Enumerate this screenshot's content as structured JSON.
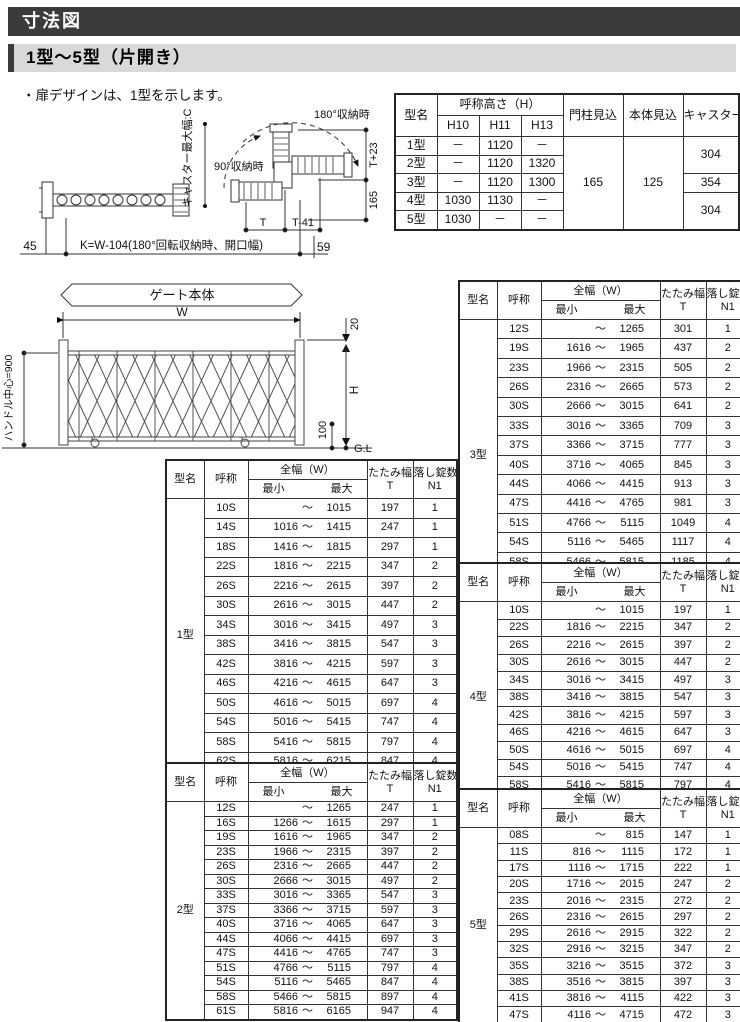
{
  "page": {
    "title": "寸法図",
    "subtitle": "1型～5型（片開き）",
    "note": "・扉デザインは、1型を示します。"
  },
  "spec_table": {
    "headers": {
      "model": "型名",
      "height_group": "呼称高さ（H）",
      "h10": "H10",
      "h11": "H11",
      "h13": "H13",
      "post_depth": "門柱見込",
      "body_depth": "本体見込",
      "caster": "キャスター最大幅（C）"
    },
    "rows": [
      {
        "model": "1型",
        "h10": "－",
        "h11": "1120",
        "h13": "－"
      },
      {
        "model": "2型",
        "h10": "－",
        "h11": "1120",
        "h13": "1320"
      },
      {
        "model": "3型",
        "h10": "－",
        "h11": "1120",
        "h13": "1300"
      },
      {
        "model": "4型",
        "h10": "1030",
        "h11": "1130",
        "h13": "－"
      },
      {
        "model": "5型",
        "h10": "1030",
        "h11": "－",
        "h13": "－"
      }
    ],
    "post_depth_value": "165",
    "body_depth_value": "125",
    "caster_spans": [
      {
        "value": "304",
        "rows": 2
      },
      {
        "value": "354",
        "rows": 1
      },
      {
        "value": "304",
        "rows": 2
      }
    ]
  },
  "size_headers": {
    "model": "型名",
    "name": "呼称",
    "width": "全幅（W）",
    "min": "最小",
    "max": "最大",
    "tilde": "～",
    "fold_line1": "たたみ幅",
    "fold_line2": "T",
    "locks_line1": "落し錠数",
    "locks_line2": "N1"
  },
  "size_tables": [
    {
      "model": "1型",
      "rows": [
        {
          "name": "10S",
          "min": "",
          "max": "1015",
          "t": "197",
          "n1": "1"
        },
        {
          "name": "14S",
          "min": "1016",
          "max": "1415",
          "t": "247",
          "n1": "1"
        },
        {
          "name": "18S",
          "min": "1416",
          "max": "1815",
          "t": "297",
          "n1": "1"
        },
        {
          "name": "22S",
          "min": "1816",
          "max": "2215",
          "t": "347",
          "n1": "2"
        },
        {
          "name": "26S",
          "min": "2216",
          "max": "2615",
          "t": "397",
          "n1": "2"
        },
        {
          "name": "30S",
          "min": "2616",
          "max": "3015",
          "t": "447",
          "n1": "2"
        },
        {
          "name": "34S",
          "min": "3016",
          "max": "3415",
          "t": "497",
          "n1": "3"
        },
        {
          "name": "38S",
          "min": "3416",
          "max": "3815",
          "t": "547",
          "n1": "3"
        },
        {
          "name": "42S",
          "min": "3816",
          "max": "4215",
          "t": "597",
          "n1": "3"
        },
        {
          "name": "46S",
          "min": "4216",
          "max": "4615",
          "t": "647",
          "n1": "3"
        },
        {
          "name": "50S",
          "min": "4616",
          "max": "5015",
          "t": "697",
          "n1": "4"
        },
        {
          "name": "54S",
          "min": "5016",
          "max": "5415",
          "t": "747",
          "n1": "4"
        },
        {
          "name": "58S",
          "min": "5416",
          "max": "5815",
          "t": "797",
          "n1": "4"
        },
        {
          "name": "62S",
          "min": "5816",
          "max": "6215",
          "t": "847",
          "n1": "4"
        }
      ]
    },
    {
      "model": "2型",
      "rows": [
        {
          "name": "12S",
          "min": "",
          "max": "1265",
          "t": "247",
          "n1": "1"
        },
        {
          "name": "16S",
          "min": "1266",
          "max": "1615",
          "t": "297",
          "n1": "1"
        },
        {
          "name": "19S",
          "min": "1616",
          "max": "1965",
          "t": "347",
          "n1": "2"
        },
        {
          "name": "23S",
          "min": "1966",
          "max": "2315",
          "t": "397",
          "n1": "2"
        },
        {
          "name": "26S",
          "min": "2316",
          "max": "2665",
          "t": "447",
          "n1": "2"
        },
        {
          "name": "30S",
          "min": "2666",
          "max": "3015",
          "t": "497",
          "n1": "2"
        },
        {
          "name": "33S",
          "min": "3016",
          "max": "3365",
          "t": "547",
          "n1": "3"
        },
        {
          "name": "37S",
          "min": "3366",
          "max": "3715",
          "t": "597",
          "n1": "3"
        },
        {
          "name": "40S",
          "min": "3716",
          "max": "4065",
          "t": "647",
          "n1": "3"
        },
        {
          "name": "44S",
          "min": "4066",
          "max": "4415",
          "t": "697",
          "n1": "3"
        },
        {
          "name": "47S",
          "min": "4416",
          "max": "4765",
          "t": "747",
          "n1": "3"
        },
        {
          "name": "51S",
          "min": "4766",
          "max": "5115",
          "t": "797",
          "n1": "4"
        },
        {
          "name": "54S",
          "min": "5116",
          "max": "5465",
          "t": "847",
          "n1": "4"
        },
        {
          "name": "58S",
          "min": "5466",
          "max": "5815",
          "t": "897",
          "n1": "4"
        },
        {
          "name": "61S",
          "min": "5816",
          "max": "6165",
          "t": "947",
          "n1": "4"
        }
      ]
    },
    {
      "model": "3型",
      "rows": [
        {
          "name": "12S",
          "min": "",
          "max": "1265",
          "t": "301",
          "n1": "1"
        },
        {
          "name": "19S",
          "min": "1616",
          "max": "1965",
          "t": "437",
          "n1": "2"
        },
        {
          "name": "23S",
          "min": "1966",
          "max": "2315",
          "t": "505",
          "n1": "2"
        },
        {
          "name": "26S",
          "min": "2316",
          "max": "2665",
          "t": "573",
          "n1": "2"
        },
        {
          "name": "30S",
          "min": "2666",
          "max": "3015",
          "t": "641",
          "n1": "2"
        },
        {
          "name": "33S",
          "min": "3016",
          "max": "3365",
          "t": "709",
          "n1": "3"
        },
        {
          "name": "37S",
          "min": "3366",
          "max": "3715",
          "t": "777",
          "n1": "3"
        },
        {
          "name": "40S",
          "min": "3716",
          "max": "4065",
          "t": "845",
          "n1": "3"
        },
        {
          "name": "44S",
          "min": "4066",
          "max": "4415",
          "t": "913",
          "n1": "3"
        },
        {
          "name": "47S",
          "min": "4416",
          "max": "4765",
          "t": "981",
          "n1": "3"
        },
        {
          "name": "51S",
          "min": "4766",
          "max": "5115",
          "t": "1049",
          "n1": "4"
        },
        {
          "name": "54S",
          "min": "5116",
          "max": "5465",
          "t": "1117",
          "n1": "4"
        },
        {
          "name": "58S",
          "min": "5466",
          "max": "5815",
          "t": "1185",
          "n1": "4"
        },
        {
          "name": "61S",
          "min": "5816",
          "max": "6165",
          "t": "1253",
          "n1": "4"
        }
      ]
    },
    {
      "model": "4型",
      "rows": [
        {
          "name": "10S",
          "min": "",
          "max": "1015",
          "t": "197",
          "n1": "1"
        },
        {
          "name": "22S",
          "min": "1816",
          "max": "2215",
          "t": "347",
          "n1": "2"
        },
        {
          "name": "26S",
          "min": "2216",
          "max": "2615",
          "t": "397",
          "n1": "2"
        },
        {
          "name": "30S",
          "min": "2616",
          "max": "3015",
          "t": "447",
          "n1": "2"
        },
        {
          "name": "34S",
          "min": "3016",
          "max": "3415",
          "t": "497",
          "n1": "3"
        },
        {
          "name": "38S",
          "min": "3416",
          "max": "3815",
          "t": "547",
          "n1": "3"
        },
        {
          "name": "42S",
          "min": "3816",
          "max": "4215",
          "t": "597",
          "n1": "3"
        },
        {
          "name": "46S",
          "min": "4216",
          "max": "4615",
          "t": "647",
          "n1": "3"
        },
        {
          "name": "50S",
          "min": "4616",
          "max": "5015",
          "t": "697",
          "n1": "4"
        },
        {
          "name": "54S",
          "min": "5016",
          "max": "5415",
          "t": "747",
          "n1": "4"
        },
        {
          "name": "58S",
          "min": "5416",
          "max": "5815",
          "t": "797",
          "n1": "4"
        }
      ]
    },
    {
      "model": "5型",
      "rows": [
        {
          "name": "08S",
          "min": "",
          "max": "815",
          "t": "147",
          "n1": "1"
        },
        {
          "name": "11S",
          "min": "816",
          "max": "1115",
          "t": "172",
          "n1": "1"
        },
        {
          "name": "17S",
          "min": "1116",
          "max": "1715",
          "t": "222",
          "n1": "1"
        },
        {
          "name": "20S",
          "min": "1716",
          "max": "2015",
          "t": "247",
          "n1": "2"
        },
        {
          "name": "23S",
          "min": "2016",
          "max": "2315",
          "t": "272",
          "n1": "2"
        },
        {
          "name": "26S",
          "min": "2316",
          "max": "2615",
          "t": "297",
          "n1": "2"
        },
        {
          "name": "29S",
          "min": "2616",
          "max": "2915",
          "t": "322",
          "n1": "2"
        },
        {
          "name": "32S",
          "min": "2916",
          "max": "3215",
          "t": "347",
          "n1": "2"
        },
        {
          "name": "35S",
          "min": "3216",
          "max": "3515",
          "t": "372",
          "n1": "3"
        },
        {
          "name": "38S",
          "min": "3516",
          "max": "3815",
          "t": "397",
          "n1": "3"
        },
        {
          "name": "41S",
          "min": "3816",
          "max": "4115",
          "t": "422",
          "n1": "3"
        },
        {
          "name": "47S",
          "min": "4116",
          "max": "4715",
          "t": "472",
          "n1": "3"
        }
      ]
    }
  ],
  "diagram_top": {
    "labels": {
      "deg180": "180°収納時",
      "deg90": "90°収納時",
      "t_plus23": "T+23",
      "v165": "165",
      "t": "T",
      "t_minus41": "T-41",
      "v45": "45",
      "k_formula": "K=W-104(180°回転収納時、開口幅)",
      "v59": "59",
      "caster_width": "キャスター最大幅:C"
    }
  },
  "diagram_gate": {
    "labels": {
      "banner": "ゲート本体",
      "w": "W",
      "v20": "20",
      "h": "H",
      "v100": "100",
      "gl": "G.L",
      "handle_center": "ハンドル中心=900"
    }
  }
}
